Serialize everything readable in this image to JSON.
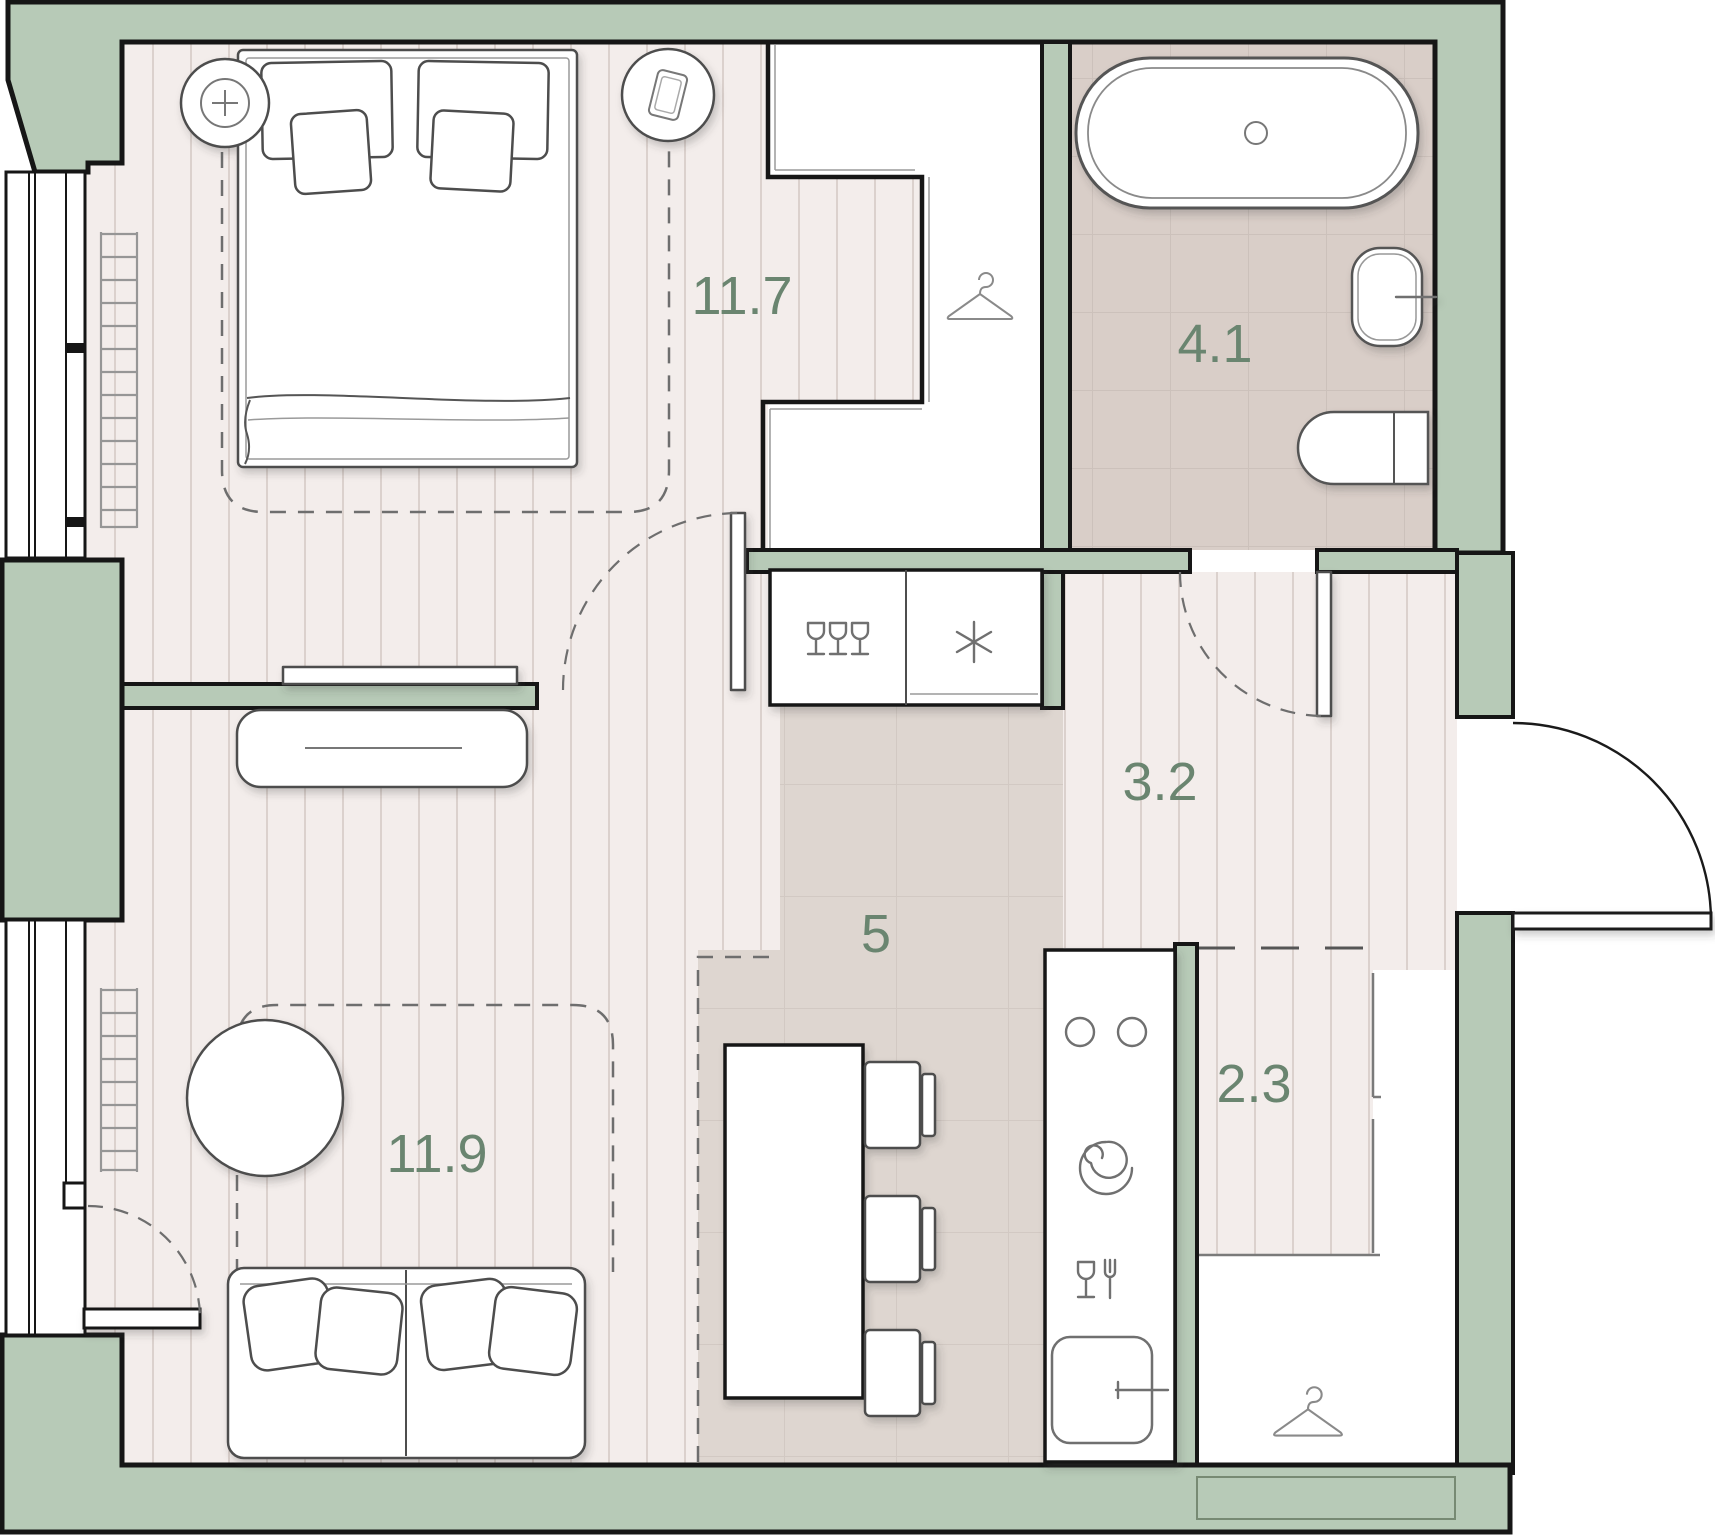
{
  "plan": {
    "type": "apartment-floor-plan",
    "rooms": [
      {
        "name": "bedroom",
        "area": "11.7"
      },
      {
        "name": "bathroom",
        "area": "4.1"
      },
      {
        "name": "hallway",
        "area": "3.2"
      },
      {
        "name": "kitchen",
        "area": "5"
      },
      {
        "name": "wardrobe",
        "area": "2.3"
      },
      {
        "name": "living-room",
        "area": "11.9"
      }
    ],
    "colors": {
      "wall_fill": "#b7cab7",
      "wall_outline": "#161616",
      "wood_floor": "#f3edeb",
      "bathroom_tile": "#d9cec8",
      "kitchen_tile": "#ded6d0",
      "label_text": "#6a8570",
      "furniture_outline": "#4d4d4d"
    },
    "icons": [
      "lamp-plus-icon",
      "phone-icon",
      "hanger-icon",
      "wine-glasses-icon",
      "snowflake-icon",
      "burner-icon",
      "spiral-hob-icon",
      "dishwasher-icon",
      "faucet-icon",
      "drain-icon"
    ]
  }
}
